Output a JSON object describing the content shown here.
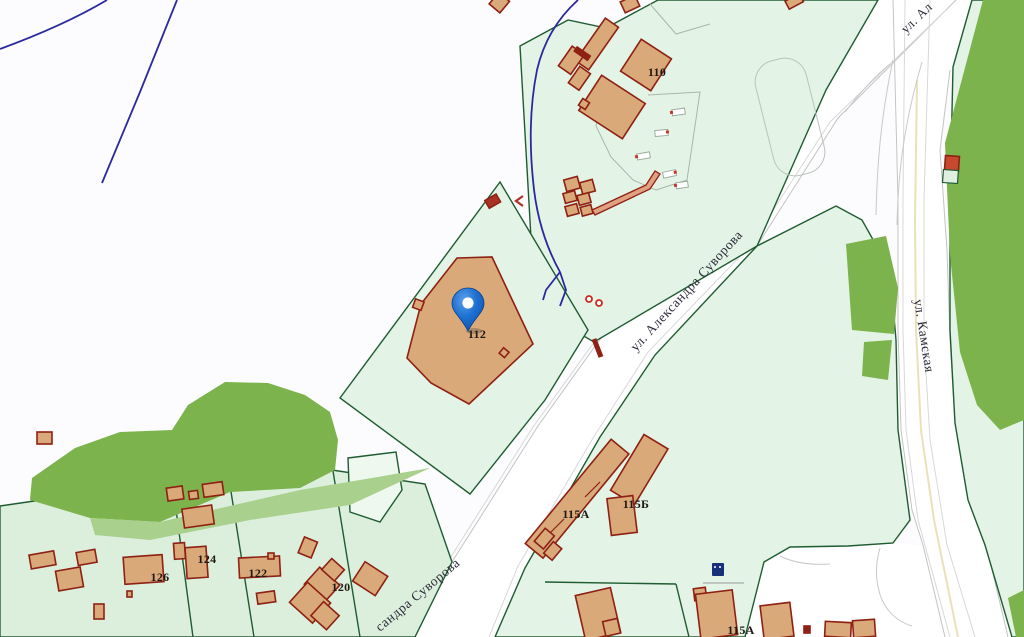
{
  "map": {
    "streets": {
      "suvorova": "ул. Александра Суворова",
      "suvorova_partial": "сандра Суворова",
      "kamskaya": "ул. Камская",
      "truncated_top_right": "ул. Ал"
    },
    "house_numbers": {
      "h110": "110",
      "h112": "112",
      "h115a_mid": "115А",
      "h115b": "115Б",
      "h115a_bottom": "115А",
      "h120": "120",
      "h122": "122",
      "h124": "124",
      "h126": "126"
    },
    "marker": {
      "color": "#1669cd"
    },
    "colors": {
      "background": "#fcfbfd",
      "parcel_fill": "#e3f3e5",
      "parcel_fill_alt": "#dcefdc",
      "parcel_fill_pale": "#eef8ee",
      "parcel_stroke": "#1f5c31",
      "vegetation": "#7cb34c",
      "vegetation_light": "#a9d08c",
      "building_fill": "#d9a979",
      "building_stroke": "#8e2014",
      "road_fill": "#ffffff",
      "road_stroke": "#bdbdbd",
      "hydro_line": "#2a2a9e",
      "street_label_color": "#2a2a3a",
      "house_label_color": "#201812"
    }
  }
}
